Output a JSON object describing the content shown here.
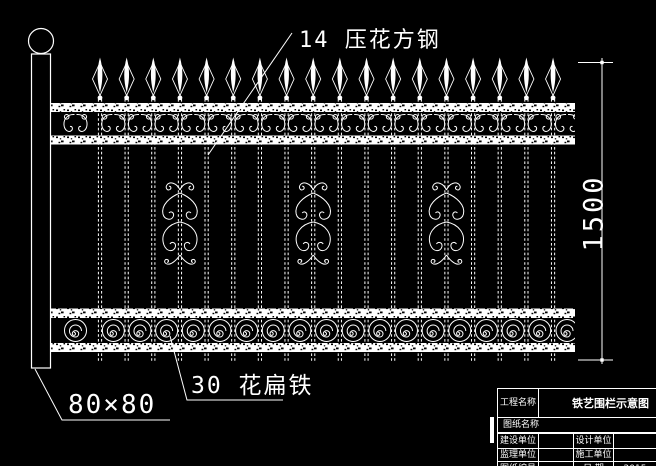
{
  "drawing": {
    "colors": {
      "background": "#000000",
      "line": "#ffffff"
    },
    "annotations": {
      "top_bar_label": "14 压花方钢",
      "bottom_band_label": "30 花扁铁",
      "post_size_label": "80×80",
      "height_dimension": "1500"
    },
    "fence": {
      "bar_count": 18,
      "first_bar_x": 100,
      "bar_spacing": 26.65,
      "ornament_bar_indices": [
        3,
        8,
        13
      ],
      "rail_left": 51,
      "rail_right": 575,
      "post": "square-post-with-ball-finial",
      "top_band": "double-scroll-motifs",
      "bottom_band": "spiral-circle-motifs"
    }
  },
  "title_block": {
    "project": {
      "label": "工程名称",
      "value": "铁艺围栏示意图"
    },
    "drawing_name": {
      "label": "图纸名称",
      "value": ""
    },
    "build": {
      "label": "建设单位",
      "value": "",
      "label2": "设计单位",
      "value2": ""
    },
    "supervise": {
      "label": "监理单位",
      "value": "",
      "label2": "施工单位",
      "value2": ""
    },
    "number": {
      "label": "图纸编号",
      "value": "",
      "label2": "日  期",
      "value2": "2015"
    }
  }
}
